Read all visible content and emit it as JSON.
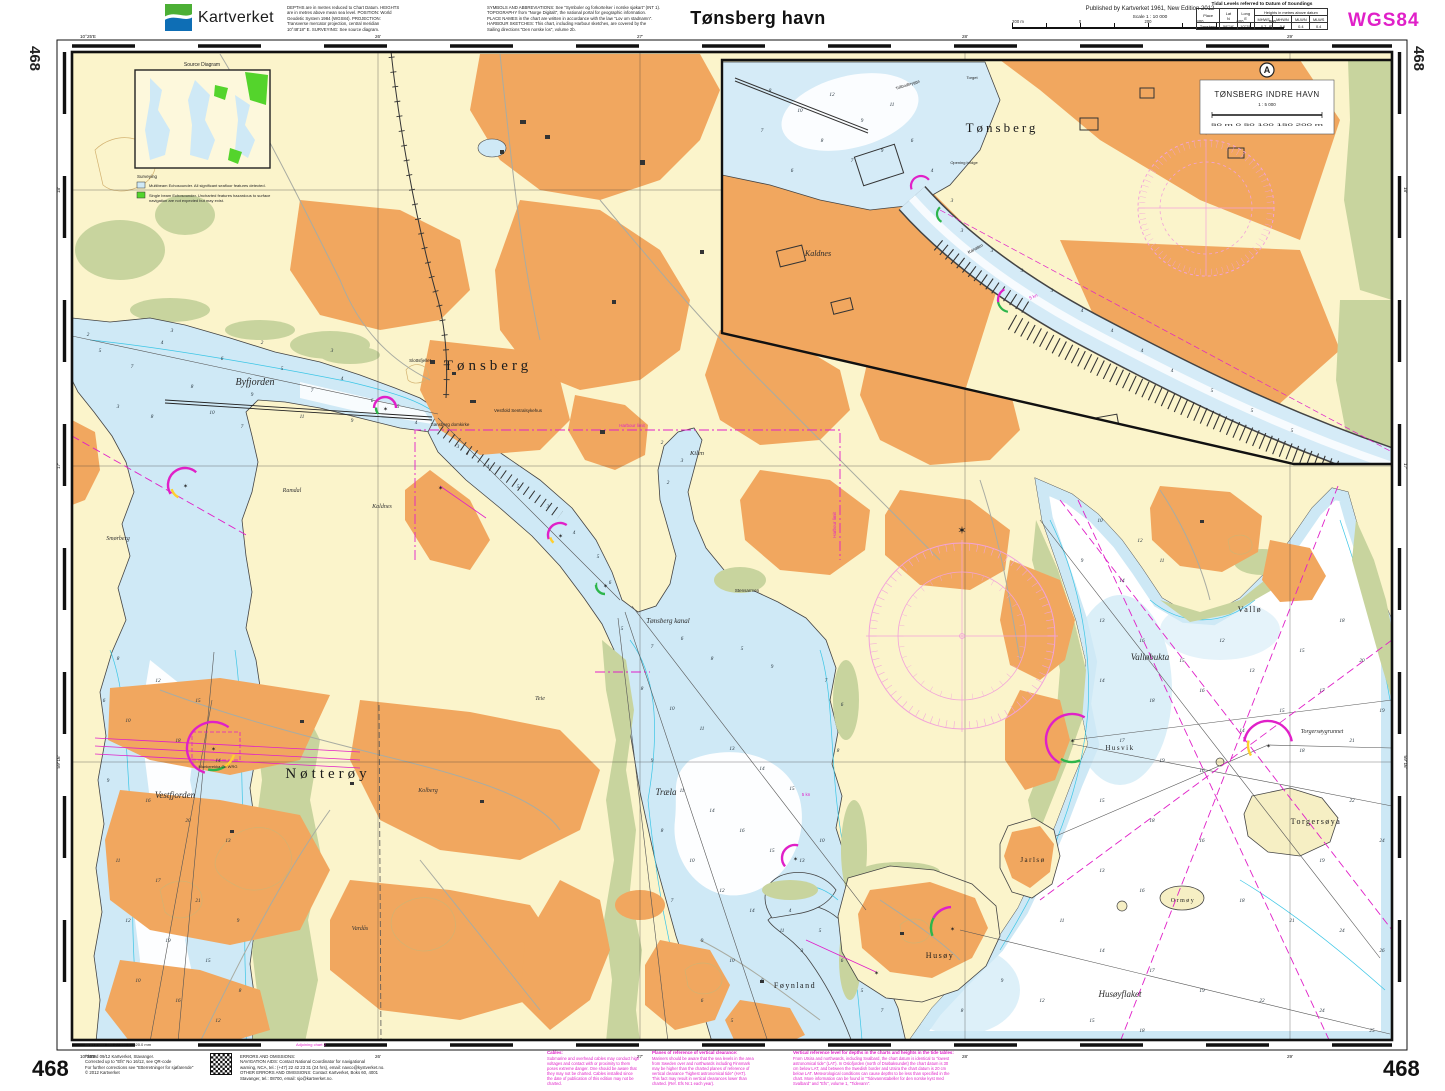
{
  "header": {
    "brand": "Kartverket",
    "notes_left": "DEPTHS are in metres reduced to Chart Datum. HEIGHTS\nare in metres above mean sea level. POSITION: World\nGeodetic System 1984 (WGS84). PROJECTION:\nTransverse mercator projection, central meridian\n10°48'18\" E. SURVEYING: See source diagram.",
    "notes_right": "SYMBOLS AND ABBREVIATIONS: See \"Symboler og forkortelser i norske sjøkart\" (INT 1).\nTOPOGRAPHY from \"Norge Digitalt\", the national portal for geographic information.\nPLACE NAMES in the chart are written in accordance with the law \"Lov om stadnamn\".\nHARBOUR SKETCHES: This chart, including Harbour sketches, are covered by the\nSailing directions \"Den norske los\", volume 2b.",
    "title": "Tønsberg havn",
    "published": "Published by Kartverket 1961, New Edition 2012",
    "scale_label": "Scale 1 : 10 000",
    "scalebar": {
      "m200": "200 m",
      "zero": "0",
      "t200": "200",
      "t400": "400",
      "t600": "600",
      "t800": "800 m"
    },
    "datum": "WGS84",
    "tidal": {
      "title": "Tidal Levels referred to Datum of Soundings",
      "place": "Place",
      "lat": "Lat\nN",
      "long": "Long\nE",
      "heights": "Heights in metres above datum",
      "cols": [
        "MHWS",
        "MHWN",
        "MLWN",
        "MLWS"
      ],
      "rows": [
        {
          "place": "Tønsberg",
          "lat": "59°16'",
          "long": "10°25'",
          "values": [
            "0.7",
            "0.6",
            "0.4",
            "0.4"
          ]
        }
      ]
    }
  },
  "frame": {
    "corner_number": "468",
    "lon_edge": "10°25'E",
    "lon": [
      {
        "x": 378,
        "t": "26'"
      },
      {
        "x": 640,
        "t": "27'"
      },
      {
        "x": 965,
        "t": "28'"
      },
      {
        "x": 1290,
        "t": "29'"
      }
    ],
    "lat": [
      {
        "y": 190,
        "t": "18'"
      },
      {
        "y": 466,
        "t": "17'"
      },
      {
        "y": 762,
        "t": "59°16'"
      }
    ]
  },
  "map": {
    "inset": {
      "badge": "A",
      "title": "TØNSBERG INDRE HAVN",
      "scale": "1 : 5 000",
      "bar": "50 m   0   50   100   150   200 m"
    },
    "source_diagram": {
      "title": "Source Diagram",
      "surveying": "Surveying",
      "item1": "Multibeam Echosounder. All significant seafloor features detected.",
      "item2": "Single beam Echosounder. Uncharted features hazardous to surface\nnavigation are not expected but may exist."
    },
    "labels": [
      {
        "t": "Tønsberg",
        "x": 488,
        "y": 370,
        "c": "city",
        "s": 15,
        "sp": 4
      },
      {
        "t": "Nøtterøy",
        "x": 328,
        "y": 778,
        "c": "city",
        "s": 15,
        "sp": 4
      },
      {
        "t": "Byfjorden",
        "x": 255,
        "y": 385,
        "c": "water",
        "s": 10
      },
      {
        "t": "Vestfjorden",
        "x": 175,
        "y": 798,
        "c": "water",
        "s": 9
      },
      {
        "t": "Træla",
        "x": 666,
        "y": 795,
        "c": "water",
        "s": 9
      },
      {
        "t": "Tønsberg kanal",
        "x": 668,
        "y": 623,
        "c": "water",
        "s": 7
      },
      {
        "t": "Kilen",
        "x": 697,
        "y": 455,
        "c": "water",
        "s": 6.5
      },
      {
        "t": "Føynland",
        "x": 795,
        "y": 988,
        "c": "place",
        "s": 8
      },
      {
        "t": "Husøy",
        "x": 940,
        "y": 958,
        "c": "place",
        "s": 8
      },
      {
        "t": "Husøyflaket",
        "x": 1120,
        "y": 997,
        "c": "water",
        "s": 9
      },
      {
        "t": "Vallø",
        "x": 1250,
        "y": 612,
        "c": "place",
        "s": 8
      },
      {
        "t": "Valløbukta",
        "x": 1150,
        "y": 660,
        "c": "water",
        "s": 9
      },
      {
        "t": "Torgersøya",
        "x": 1316,
        "y": 824,
        "c": "place",
        "s": 8
      },
      {
        "t": "Torgersøygrunnet",
        "x": 1322,
        "y": 733,
        "c": "water",
        "s": 6
      },
      {
        "t": "Jarlsø",
        "x": 1033,
        "y": 862,
        "c": "place",
        "s": 7
      },
      {
        "t": "Ormøy",
        "x": 1183,
        "y": 902,
        "c": "place",
        "s": 6
      },
      {
        "t": "Husvik",
        "x": 1120,
        "y": 750,
        "c": "place",
        "s": 7
      },
      {
        "t": "Kolberg",
        "x": 428,
        "y": 792,
        "c": "small",
        "s": 6
      },
      {
        "t": "Kaldnes",
        "x": 382,
        "y": 508,
        "c": "small",
        "s": 6
      },
      {
        "t": "Ramdal",
        "x": 292,
        "y": 492,
        "c": "small",
        "s": 6
      },
      {
        "t": "Smørberg",
        "x": 118,
        "y": 540,
        "c": "small",
        "s": 6
      },
      {
        "t": "Vardås",
        "x": 360,
        "y": 930,
        "c": "small",
        "s": 6
      },
      {
        "t": "Teie",
        "x": 540,
        "y": 700,
        "c": "small",
        "s": 6
      },
      {
        "t": "Slottsfjellet",
        "x": 420,
        "y": 362,
        "c": "tiny",
        "s": 4.5
      },
      {
        "t": "Tønsberg domkirke",
        "x": 450,
        "y": 426,
        "c": "tiny",
        "s": 4.5
      },
      {
        "t": "Vestfold Sentralsykehus",
        "x": 518,
        "y": 412,
        "c": "tiny",
        "s": 4.5
      },
      {
        "t": "Stensarmen",
        "x": 747,
        "y": 592,
        "c": "tiny",
        "s": 4.5
      },
      {
        "t": "Munkerekka  Oc WRG",
        "x": 218,
        "y": 768,
        "c": "tiny",
        "s": 4
      },
      {
        "t": "Harbour limit",
        "x": 632,
        "y": 427,
        "c": "mag",
        "s": 4.5
      },
      {
        "t": "Harbour limit",
        "x": 836,
        "y": 525,
        "c": "mag",
        "s": 4.5,
        "r": -90
      },
      {
        "t": "5 kn",
        "x": 806,
        "y": 796,
        "c": "mag",
        "s": 4.5
      },
      {
        "t": "Tønsberg",
        "x": 1002,
        "y": 132,
        "c": "city",
        "s": 13,
        "sp": 3
      },
      {
        "t": "Kaldnes",
        "x": 818,
        "y": 256,
        "c": "water",
        "s": 8
      },
      {
        "t": "Kanalen",
        "x": 976,
        "y": 250,
        "c": "tiny",
        "s": 4.5,
        "r": -28
      },
      {
        "t": "Tollbodbrygga",
        "x": 908,
        "y": 86,
        "c": "tiny",
        "s": 4,
        "r": -18
      },
      {
        "t": "Torget",
        "x": 972,
        "y": 79,
        "c": "tiny",
        "s": 4
      },
      {
        "t": "Opening bridge",
        "x": 964,
        "y": 164,
        "c": "tiny",
        "s": 4
      },
      {
        "t": "5 kn",
        "x": 1034,
        "y": 298,
        "c": "mag",
        "s": 4.5,
        "r": -25
      }
    ],
    "soundings": [
      [
        100,
        352,
        5
      ],
      [
        132,
        368,
        7
      ],
      [
        162,
        344,
        4
      ],
      [
        192,
        388,
        8
      ],
      [
        222,
        360,
        6
      ],
      [
        252,
        396,
        9
      ],
      [
        282,
        370,
        5
      ],
      [
        312,
        392,
        7
      ],
      [
        342,
        380,
        4
      ],
      [
        372,
        402,
        6
      ],
      [
        118,
        408,
        3
      ],
      [
        152,
        418,
        8
      ],
      [
        212,
        414,
        10
      ],
      [
        242,
        428,
        7
      ],
      [
        302,
        418,
        11
      ],
      [
        352,
        422,
        9
      ],
      [
        88,
        336,
        2
      ],
      [
        172,
        332,
        3
      ],
      [
        262,
        344,
        2
      ],
      [
        332,
        352,
        3
      ],
      [
        398,
        408,
        5
      ],
      [
        416,
        424,
        4
      ],
      [
        118,
        660,
        8
      ],
      [
        158,
        682,
        12
      ],
      [
        198,
        702,
        15
      ],
      [
        128,
        722,
        10
      ],
      [
        178,
        742,
        18
      ],
      [
        218,
        762,
        14
      ],
      [
        108,
        782,
        9
      ],
      [
        148,
        802,
        16
      ],
      [
        188,
        822,
        20
      ],
      [
        228,
        842,
        13
      ],
      [
        118,
        862,
        11
      ],
      [
        158,
        882,
        17
      ],
      [
        198,
        902,
        21
      ],
      [
        128,
        922,
        12
      ],
      [
        168,
        942,
        19
      ],
      [
        208,
        962,
        15
      ],
      [
        138,
        982,
        10
      ],
      [
        178,
        1002,
        16
      ],
      [
        218,
        1022,
        12
      ],
      [
        104,
        702,
        6
      ],
      [
        238,
        922,
        9
      ],
      [
        240,
        992,
        8
      ],
      [
        458,
        448,
        3
      ],
      [
        488,
        468,
        4
      ],
      [
        518,
        488,
        5
      ],
      [
        548,
        508,
        3
      ],
      [
        574,
        534,
        4
      ],
      [
        598,
        558,
        5
      ],
      [
        610,
        584,
        6
      ],
      [
        662,
        444,
        2
      ],
      [
        682,
        462,
        3
      ],
      [
        668,
        484,
        2
      ],
      [
        622,
        630,
        5
      ],
      [
        652,
        648,
        7
      ],
      [
        682,
        640,
        6
      ],
      [
        712,
        660,
        8
      ],
      [
        742,
        650,
        5
      ],
      [
        772,
        668,
        9
      ],
      [
        642,
        690,
        8
      ],
      [
        672,
        710,
        10
      ],
      [
        702,
        730,
        11
      ],
      [
        732,
        750,
        13
      ],
      [
        762,
        770,
        14
      ],
      [
        792,
        790,
        15
      ],
      [
        652,
        762,
        9
      ],
      [
        682,
        792,
        11
      ],
      [
        712,
        812,
        14
      ],
      [
        742,
        832,
        16
      ],
      [
        772,
        852,
        15
      ],
      [
        802,
        862,
        13
      ],
      [
        662,
        832,
        8
      ],
      [
        692,
        862,
        10
      ],
      [
        722,
        892,
        12
      ],
      [
        752,
        912,
        14
      ],
      [
        782,
        932,
        11
      ],
      [
        672,
        902,
        7
      ],
      [
        702,
        942,
        9
      ],
      [
        732,
        962,
        10
      ],
      [
        762,
        982,
        8
      ],
      [
        702,
        1002,
        6
      ],
      [
        732,
        1022,
        5
      ],
      [
        822,
        842,
        10
      ],
      [
        838,
        752,
        8
      ],
      [
        842,
        706,
        6
      ],
      [
        826,
        682,
        7
      ],
      [
        790,
        912,
        4
      ],
      [
        820,
        932,
        5
      ],
      [
        802,
        952,
        3
      ],
      [
        842,
        962,
        6
      ],
      [
        862,
        992,
        5
      ],
      [
        882,
        1012,
        7
      ],
      [
        1100,
        522,
        10
      ],
      [
        1140,
        542,
        12
      ],
      [
        1082,
        562,
        9
      ],
      [
        1122,
        582,
        14
      ],
      [
        1162,
        562,
        11
      ],
      [
        1102,
        622,
        13
      ],
      [
        1142,
        642,
        16
      ],
      [
        1182,
        662,
        15
      ],
      [
        1222,
        642,
        12
      ],
      [
        1102,
        682,
        14
      ],
      [
        1152,
        702,
        18
      ],
      [
        1202,
        692,
        16
      ],
      [
        1252,
        672,
        13
      ],
      [
        1302,
        652,
        15
      ],
      [
        1342,
        622,
        18
      ],
      [
        1362,
        662,
        20
      ],
      [
        1322,
        692,
        17
      ],
      [
        1282,
        712,
        15
      ],
      [
        1242,
        732,
        14
      ],
      [
        1122,
        742,
        17
      ],
      [
        1162,
        762,
        19
      ],
      [
        1202,
        772,
        16
      ],
      [
        1302,
        752,
        18
      ],
      [
        1352,
        742,
        21
      ],
      [
        1382,
        712,
        19
      ],
      [
        1102,
        802,
        15
      ],
      [
        1152,
        822,
        18
      ],
      [
        1202,
        842,
        16
      ],
      [
        1352,
        802,
        22
      ],
      [
        1382,
        842,
        24
      ],
      [
        1322,
        862,
        19
      ],
      [
        1102,
        872,
        13
      ],
      [
        1142,
        892,
        16
      ],
      [
        1242,
        902,
        18
      ],
      [
        1292,
        922,
        21
      ],
      [
        1342,
        932,
        24
      ],
      [
        1382,
        952,
        26
      ],
      [
        1062,
        922,
        11
      ],
      [
        1102,
        952,
        14
      ],
      [
        1152,
        972,
        17
      ],
      [
        1202,
        992,
        19
      ],
      [
        1262,
        1002,
        22
      ],
      [
        1322,
        1012,
        24
      ],
      [
        1372,
        1032,
        25
      ],
      [
        1002,
        982,
        9
      ],
      [
        962,
        1012,
        8
      ],
      [
        1042,
        1002,
        12
      ],
      [
        1092,
        1022,
        15
      ],
      [
        1142,
        1032,
        18
      ],
      [
        770,
        92,
        8
      ],
      [
        800,
        112,
        10
      ],
      [
        832,
        96,
        12
      ],
      [
        862,
        122,
        9
      ],
      [
        892,
        106,
        11
      ],
      [
        822,
        142,
        8
      ],
      [
        852,
        162,
        7
      ],
      [
        882,
        152,
        9
      ],
      [
        912,
        142,
        6
      ],
      [
        792,
        172,
        6
      ],
      [
        932,
        172,
        4
      ],
      [
        952,
        202,
        3
      ],
      [
        962,
        232,
        3
      ],
      [
        762,
        132,
        7
      ],
      [
        992,
        252,
        3
      ],
      [
        1022,
        272,
        3
      ],
      [
        1052,
        292,
        3
      ],
      [
        1082,
        312,
        4
      ],
      [
        1112,
        332,
        4
      ],
      [
        1142,
        352,
        4
      ],
      [
        1172,
        372,
        4
      ],
      [
        1212,
        392,
        5
      ],
      [
        1252,
        412,
        5
      ],
      [
        1292,
        432,
        5
      ]
    ]
  },
  "footer": {
    "chart_number": "468",
    "inner_frame_note": "Inner frame 590.2 / 995.0 : 620.0 mm",
    "adjoining": "Adjoining chart 2",
    "plotted": "Plotted 09/12 Kartverket, Stavanger.\nCorrected up to \"Efs\" No 16/12, see QR-code\nFor further corrections see \"Etterretninger for sjøfarende\"\n© 2012 Kartverket",
    "errors": "ERRORS AND OMISSIONS:\nNAVIGATION AIDS: Contact National Coordinator for navigational\nwarning, NCA, tel.: (+47) 22 42 23 31 (24 hrs), email: navco@kystverket.no.\nOTHER ERRORS AND OMISSIONS: Contact Kartverket, Boks 60, 4001\nStavanger, tel.: 08700, email: sjo@kartverket.no.",
    "notes": [
      {
        "title": "Cables:",
        "body": "Submarine and overhead cables may conduct high\nvoltages and contact with or proximity to them\nposes extreme danger. One should be aware that\nthey may not be charted. Cables installed since\nthe date of publication of this edition may not be\ncharted."
      },
      {
        "title": "Planes of reference of vertical clearance:",
        "body": "Mariners should be aware that the sea levels in the area\nfrom Sweden over and northwards including Finnmark\nmay be higher than the charted planes of reference of\nvertical clearance \"highest astronomical tide\" (HAT).\nThis fact may result in vertical clearances lower than\ncharted. (Ref. Efs Nr.1 each year)."
      },
      {
        "title": "Vertical reference level for depths in the charts and heights in the tide tables:",
        "body": "From Utsira and northwards, including Svalbard, the chart datum is identical to \"lowest\nastronomical tide\" (LAT). In Oslofjorden (north of Drøbaksundet) the chart datum is 30\ncm below LAT, and between the Swedish border and Utsira the chart datum is 20 cm\nbelow LAT. Meteorological conditions can cause depths to be less than specified in the\nchart. More information can be found in \"Tidevannstabeller for den norske kyst med\nSvalbard\" and \"Efs\", volume 1, \"Tidevann\"."
      }
    ]
  }
}
